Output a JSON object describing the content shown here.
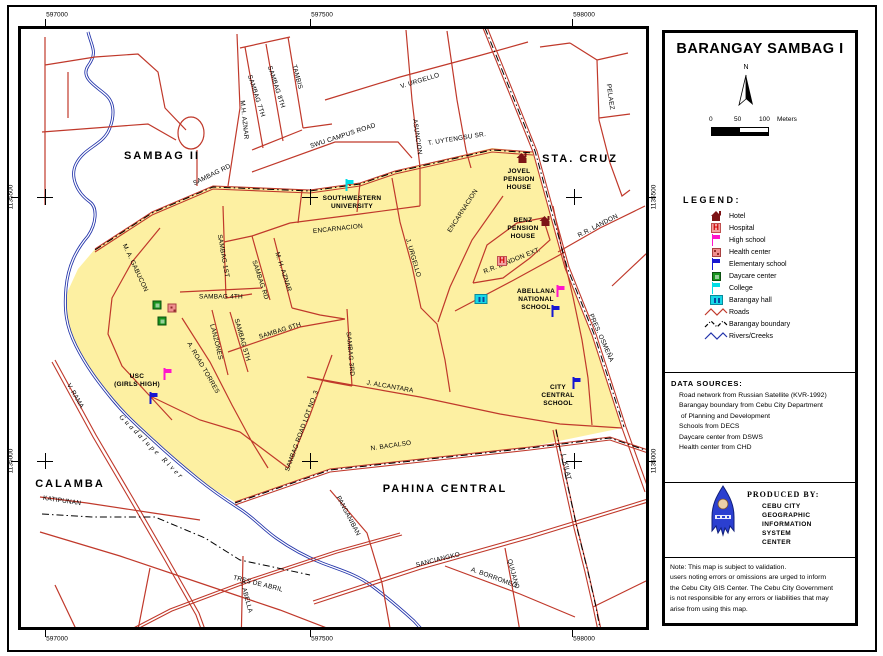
{
  "colors": {
    "barangay_fill": "#fdf0a2",
    "road": "#c0392b",
    "river": "#2233aa",
    "boundary": "#000000",
    "hotel": "#7d1416",
    "high_school": "#ff14cc",
    "elementary": "#1616d2",
    "college": "#00dde6",
    "daycare": "#18941d",
    "health_center": "#ef8f8f",
    "barangay_hall": "#17d8e8",
    "hospital_bg": "#f2a2a2"
  },
  "grid": {
    "top_labels": [
      {
        "text": "597000",
        "x": 45
      },
      {
        "text": "597500",
        "x": 310
      },
      {
        "text": "598000",
        "x": 572
      }
    ],
    "bottom_labels": [
      {
        "text": "597000",
        "x": 45
      },
      {
        "text": "597500",
        "x": 310
      },
      {
        "text": "598000",
        "x": 572
      }
    ],
    "left_labels": [
      {
        "text": "1135500",
        "y": 197
      },
      {
        "text": "1135000",
        "y": 461
      }
    ],
    "right_labels": [
      {
        "text": "1135500",
        "y": 197
      },
      {
        "text": "1135000",
        "y": 461
      }
    ],
    "crosshairs": [
      [
        45,
        197
      ],
      [
        310,
        197
      ],
      [
        574,
        197
      ],
      [
        45,
        461
      ],
      [
        310,
        461
      ],
      [
        574,
        461
      ]
    ]
  },
  "map": {
    "area_labels": [
      {
        "t": "SAMBAG II",
        "x": 162,
        "y": 156
      },
      {
        "t": "STA. CRUZ",
        "x": 580,
        "y": 159
      },
      {
        "t": "CALAMBA",
        "x": 70,
        "y": 484
      },
      {
        "t": "PAHINA CENTRAL",
        "x": 445,
        "y": 489
      }
    ],
    "street_labels": [
      {
        "t": "TAMBIS",
        "x": 297,
        "y": 77,
        "r": 75
      },
      {
        "t": "SAMBAG 8TH",
        "x": 276,
        "y": 87,
        "r": 72
      },
      {
        "t": "SAMBAG 7TH",
        "x": 256,
        "y": 96,
        "r": 72
      },
      {
        "t": "M.H. AZNAR",
        "x": 244,
        "y": 120,
        "r": 84
      },
      {
        "t": "V. URGELLO",
        "x": 420,
        "y": 81,
        "r": -17
      },
      {
        "t": "ASUNCION",
        "x": 417,
        "y": 137,
        "r": 82
      },
      {
        "t": "SWU CAMPUS ROAD",
        "x": 343,
        "y": 136,
        "r": -18
      },
      {
        "t": "T. UYTENGSU SR.",
        "x": 457,
        "y": 139,
        "r": -9
      },
      {
        "t": "PELAEZ",
        "x": 610,
        "y": 97,
        "r": 82
      },
      {
        "t": "SAMBAG RD",
        "x": 212,
        "y": 175,
        "r": -26
      },
      {
        "t": "ENCARNACION",
        "x": 338,
        "y": 229,
        "r": -6
      },
      {
        "t": "ENCARNACION",
        "x": 463,
        "y": 211,
        "r": -57
      },
      {
        "t": "M. A. GABUCON",
        "x": 135,
        "y": 268,
        "r": 65
      },
      {
        "t": "SAMBAG 1ST",
        "x": 223,
        "y": 256,
        "r": 80
      },
      {
        "t": "SAMBAG RD",
        "x": 260,
        "y": 280,
        "r": 72
      },
      {
        "t": "M. H. AZNAR",
        "x": 283,
        "y": 272,
        "r": 72
      },
      {
        "t": "SAMBAG 4TH",
        "x": 221,
        "y": 297,
        "r": 0
      },
      {
        "t": "LANZONES",
        "x": 216,
        "y": 342,
        "r": 76
      },
      {
        "t": "SAMBAG 5TH",
        "x": 242,
        "y": 340,
        "r": 74
      },
      {
        "t": "SAMBAG 6TH",
        "x": 280,
        "y": 331,
        "r": -17
      },
      {
        "t": "A. ROAD TORRES",
        "x": 203,
        "y": 368,
        "r": 60
      },
      {
        "t": "SAMBAG 3RD",
        "x": 350,
        "y": 354,
        "r": 85
      },
      {
        "t": "J. URGELLO",
        "x": 413,
        "y": 258,
        "r": 74
      },
      {
        "t": "R.R. LANDON",
        "x": 598,
        "y": 226,
        "r": -27
      },
      {
        "t": "R.R. LANDON EXT.",
        "x": 512,
        "y": 261,
        "r": -22
      },
      {
        "t": "PRES. OSMEÑA",
        "x": 601,
        "y": 338,
        "r": 66
      },
      {
        "t": "J. ALCANTARA",
        "x": 390,
        "y": 387,
        "r": 10
      },
      {
        "t": "SAMBAG ROAD LOT NO. 3",
        "x": 302,
        "y": 431,
        "r": -70
      },
      {
        "t": "N. BACALSO",
        "x": 391,
        "y": 446,
        "r": -8
      },
      {
        "t": "L. KILAT",
        "x": 566,
        "y": 467,
        "r": 78
      },
      {
        "t": "V. RAMA",
        "x": 75,
        "y": 396,
        "r": 60
      },
      {
        "t": "KATIPUNAN",
        "x": 62,
        "y": 501,
        "r": 8
      },
      {
        "t": "PANGANIBAN",
        "x": 348,
        "y": 516,
        "r": 62
      },
      {
        "t": "SANCIANGKO",
        "x": 438,
        "y": 560,
        "r": -14
      },
      {
        "t": "A. BORROMEO",
        "x": 494,
        "y": 578,
        "r": 20
      },
      {
        "t": "QUIJANO",
        "x": 513,
        "y": 574,
        "r": 75
      },
      {
        "t": "TRES DE ABRIL",
        "x": 258,
        "y": 584,
        "r": 14
      },
      {
        "t": "T. ABELLA",
        "x": 246,
        "y": 597,
        "r": 75
      }
    ],
    "river_label": {
      "t": "Guadalupe River",
      "x": 152,
      "y": 447,
      "r": 45
    },
    "poi_labels": [
      {
        "lines": [
          "SOUTHWESTERN",
          "UNIVERSITY"
        ],
        "x": 352,
        "y": 203
      },
      {
        "lines": [
          "JOVEL",
          "PENSION",
          "HOUSE"
        ],
        "x": 519,
        "y": 180
      },
      {
        "lines": [
          "BENZ",
          "PENSION",
          "HOUSE"
        ],
        "x": 523,
        "y": 229
      },
      {
        "lines": [
          "ABELLANA",
          "NATIONAL",
          "SCHOOL"
        ],
        "x": 536,
        "y": 300
      },
      {
        "lines": [
          "USC",
          "(GIRLS HIGH)"
        ],
        "x": 137,
        "y": 381
      },
      {
        "lines": [
          "CITY",
          "CENTRAL",
          "SCHOOL"
        ],
        "x": 558,
        "y": 396
      }
    ],
    "markers": [
      {
        "type": "college",
        "x": 350,
        "y": 185
      },
      {
        "type": "hotel",
        "x": 522,
        "y": 158
      },
      {
        "type": "hotel",
        "x": 545,
        "y": 221
      },
      {
        "type": "hospital",
        "x": 502,
        "y": 261
      },
      {
        "type": "hall",
        "x": 481,
        "y": 299
      },
      {
        "type": "highschool",
        "x": 561,
        "y": 291
      },
      {
        "type": "elementary",
        "x": 556,
        "y": 311
      },
      {
        "type": "daycare",
        "x": 157,
        "y": 305
      },
      {
        "type": "daycare",
        "x": 162,
        "y": 321
      },
      {
        "type": "healthcenter",
        "x": 172,
        "y": 308
      },
      {
        "type": "highschool",
        "x": 168,
        "y": 374
      },
      {
        "type": "elementary",
        "x": 154,
        "y": 398
      },
      {
        "type": "elementary",
        "x": 577,
        "y": 383
      }
    ]
  },
  "panel": {
    "title": "BARANGAY SAMBAG I",
    "north_label": "N",
    "scale": {
      "ticks": [
        "0",
        "50",
        "100"
      ],
      "unit": "Meters"
    },
    "legend_title": "LEGEND:",
    "legend": [
      {
        "icon": "hotel",
        "label": "Hotel"
      },
      {
        "icon": "hospital",
        "label": "Hospital"
      },
      {
        "icon": "highschool",
        "label": "High school"
      },
      {
        "icon": "healthcenter",
        "label": "Health center"
      },
      {
        "icon": "elementary",
        "label": "Elementary school"
      },
      {
        "icon": "daycare",
        "label": "Daycare center"
      },
      {
        "icon": "college",
        "label": "College"
      },
      {
        "icon": "hall",
        "label": "Barangay hall"
      },
      {
        "icon": "roads-line",
        "label": "Roads"
      },
      {
        "icon": "boundary-line",
        "label": "Barangay boundary"
      },
      {
        "icon": "river-line",
        "label": "Rivers/Creeks"
      }
    ],
    "data_sources_title": "DATA SOURCES:",
    "data_sources": [
      "Road network from Russian Satellite (KVR-1992)",
      "Barangay boundary from Cebu City Department",
      " of Planning and Development",
      "Schools from DECS",
      "Daycare center from DSWS",
      "Health center from CHD"
    ],
    "produced_by_title": "PRODUCED BY:",
    "produced_by": [
      "CEBU CITY",
      "GEOGRAPHIC",
      "INFORMATION",
      "SYSTEM",
      "CENTER"
    ],
    "note_lines": [
      "Note: This map is subject to validation.",
      "users noting errors or omissions are urged to inform",
      "the Cebu City GIS Center. The Cebu City Government",
      "is not responsible for any errors or liabilities that may",
      "arise from using this map."
    ]
  }
}
